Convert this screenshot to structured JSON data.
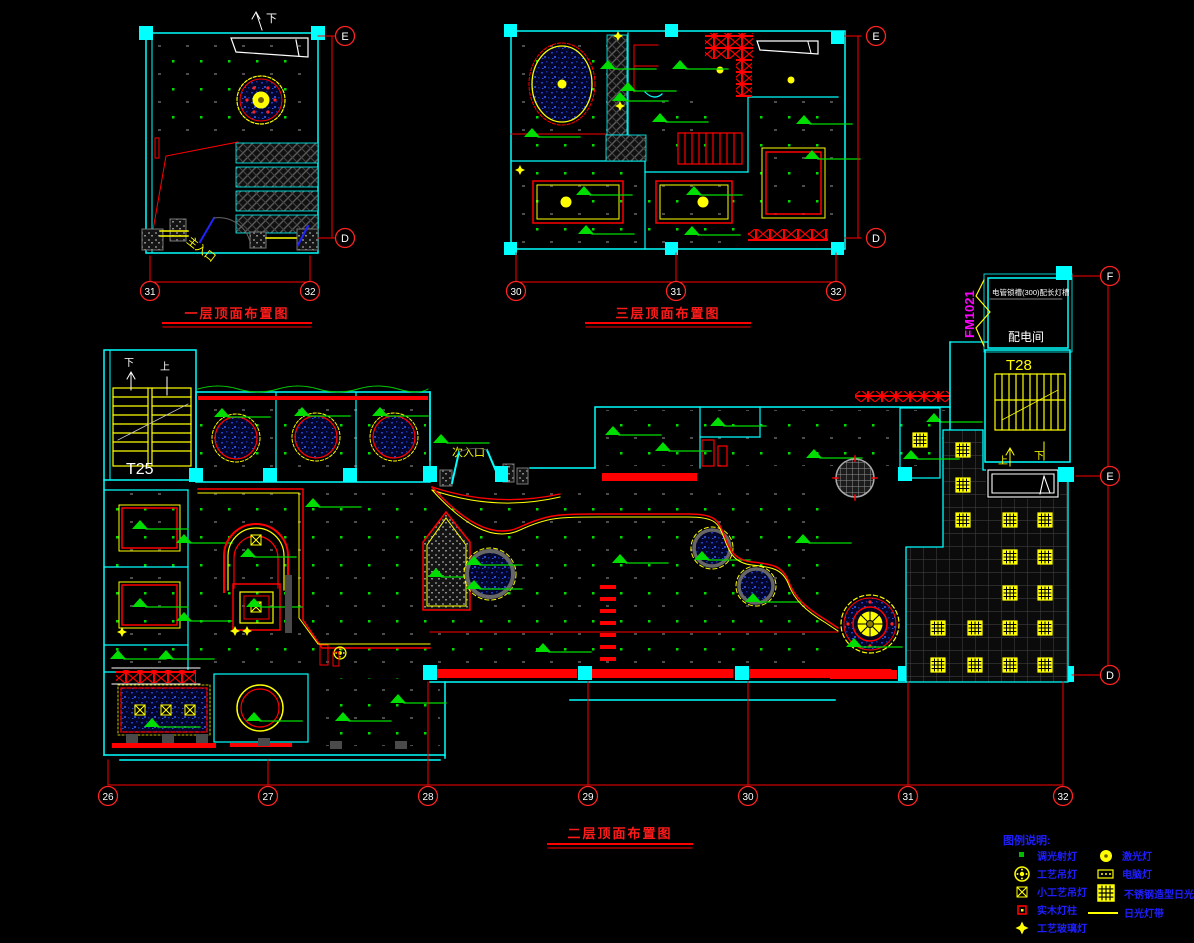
{
  "colors": {
    "wall_cyan": "#00FFFF",
    "dim_red": "#FF0000",
    "fixture_yellow": "#FFFF00",
    "symbol_green": "#00DD00",
    "door_magenta": "#FF00FF",
    "legend_blue": "#1E1EFF",
    "text_white": "#FFFFFF"
  },
  "plan_first": {
    "title": "一层顶面布置图",
    "cols": [
      "31",
      "32"
    ],
    "rows": [
      "E",
      "D"
    ],
    "main_entrance": "主入口",
    "down": "下"
  },
  "plan_third": {
    "title": "三层顶面布置图",
    "cols": [
      "30",
      "31",
      "32"
    ],
    "rows": [
      "E",
      "D"
    ]
  },
  "plan_second": {
    "title": "二层顶面布置图",
    "cols": [
      "26",
      "27",
      "28",
      "29",
      "30",
      "31",
      "32"
    ],
    "rows": [
      "F",
      "E",
      "D"
    ],
    "stair_t25": "T25",
    "stair_t28": "T28",
    "power_room": "配电间",
    "fire_door": "FM1021",
    "secondary_entrance": "次入口",
    "up": "上",
    "down": "下",
    "ceiling_note": "电管锁槽(300)配长灯槽"
  },
  "legend": {
    "title": "图例说明:",
    "left": [
      {
        "label": "调光射灯",
        "symbol": "green-square"
      },
      {
        "label": "工艺吊灯",
        "symbol": "yellow-ring-cross"
      },
      {
        "label": "小工艺吊灯",
        "symbol": "yellow-x-square"
      },
      {
        "label": "实木灯柱",
        "symbol": "red-square"
      },
      {
        "label": "工艺玻璃灯",
        "symbol": "yellow-star"
      },
      {
        "label": "激光灯",
        "symbol": "yellow-dot"
      },
      {
        "label": "电脑灯",
        "symbol": "yellow-dash-box"
      },
      {
        "label": "不锈钢造型日光灯",
        "symbol": "yellow-grid-square"
      },
      {
        "label": "日光灯带",
        "symbol": "yellow-line"
      }
    ]
  }
}
